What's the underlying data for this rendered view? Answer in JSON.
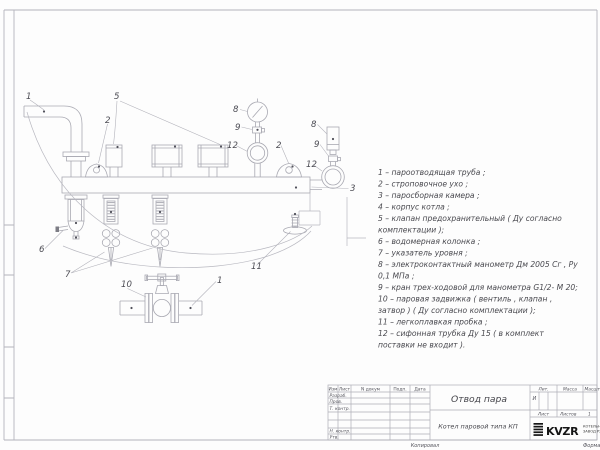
{
  "sheet": {
    "copied_label": "Копировал",
    "format_label": "Формат А4"
  },
  "parts_list": {
    "lines": [
      "1 –  пароотводящая труба ;",
      "2 –  строповочное ухо ;",
      "3 –  паросборная камера ;",
      "4 –  корпус котла ;",
      "5 –  клапан предохранительный  ( Ду согласно",
      "комплектации );",
      "6 –  водомерная колонка ;",
      "7 – указатель уровня ;",
      "8 – электроконтактный манометр  Дм 2005 Сг ,  Ру",
      "0,1  МПа ;",
      "9 –  кран трех-ходовой для манометра  G1/2- М 20;",
      "10 –  паровая задвижка  ( вентиль ,  клапан ,",
      "затвор ) ( Ду согласно комплектации );",
      "11 –  легкоплавкая пробка ;",
      "12 –  сифонная трубка Ду 15 ( в комплект",
      "поставки не входит )."
    ]
  },
  "title_block": {
    "doc_title": "Отвод пара",
    "product": "Котел паровой типа КП",
    "columns": {
      "izm": "Изм",
      "list": "Лист",
      "n_dokum": "N докум",
      "podp": "Подп.",
      "data": "Дата"
    },
    "rows": {
      "razrab": "Разраб.",
      "prov": "Пров.",
      "t_kontr": "Т. контр.",
      "n_kontr": "Н. контр.",
      "utv": "Утв."
    },
    "lit_label": "Лит.",
    "massa_label": "Масса",
    "masshtab_label": "Масшт",
    "lit_value": "И",
    "list_label": "Лист",
    "listov_label": "Листов",
    "listov_value": "1",
    "logo_text": "KVZR",
    "company_line1": "КОТЕЛЬНЫ",
    "company_line2": "ЗАВОД РЗ"
  },
  "drawing": {
    "callouts": [
      {
        "label": "1",
        "x": 26,
        "y": 99
      },
      {
        "label": "5",
        "x": 114,
        "y": 99
      },
      {
        "label": "2",
        "x": 105,
        "y": 123
      },
      {
        "label": "8",
        "x": 233,
        "y": 112
      },
      {
        "label": "9",
        "x": 235,
        "y": 130
      },
      {
        "label": "12",
        "x": 227,
        "y": 148
      },
      {
        "label": "2",
        "x": 276,
        "y": 148
      },
      {
        "label": "8",
        "x": 311,
        "y": 127
      },
      {
        "label": "9",
        "x": 314,
        "y": 147
      },
      {
        "label": "12",
        "x": 306,
        "y": 167
      },
      {
        "label": "3",
        "x": 350,
        "y": 191
      },
      {
        "label": "6",
        "x": 39,
        "y": 252
      },
      {
        "label": "7",
        "x": 65,
        "y": 277
      },
      {
        "label": "10",
        "x": 121,
        "y": 287
      },
      {
        "label": "1",
        "x": 217,
        "y": 283
      },
      {
        "label": "11",
        "x": 251,
        "y": 269
      }
    ]
  }
}
